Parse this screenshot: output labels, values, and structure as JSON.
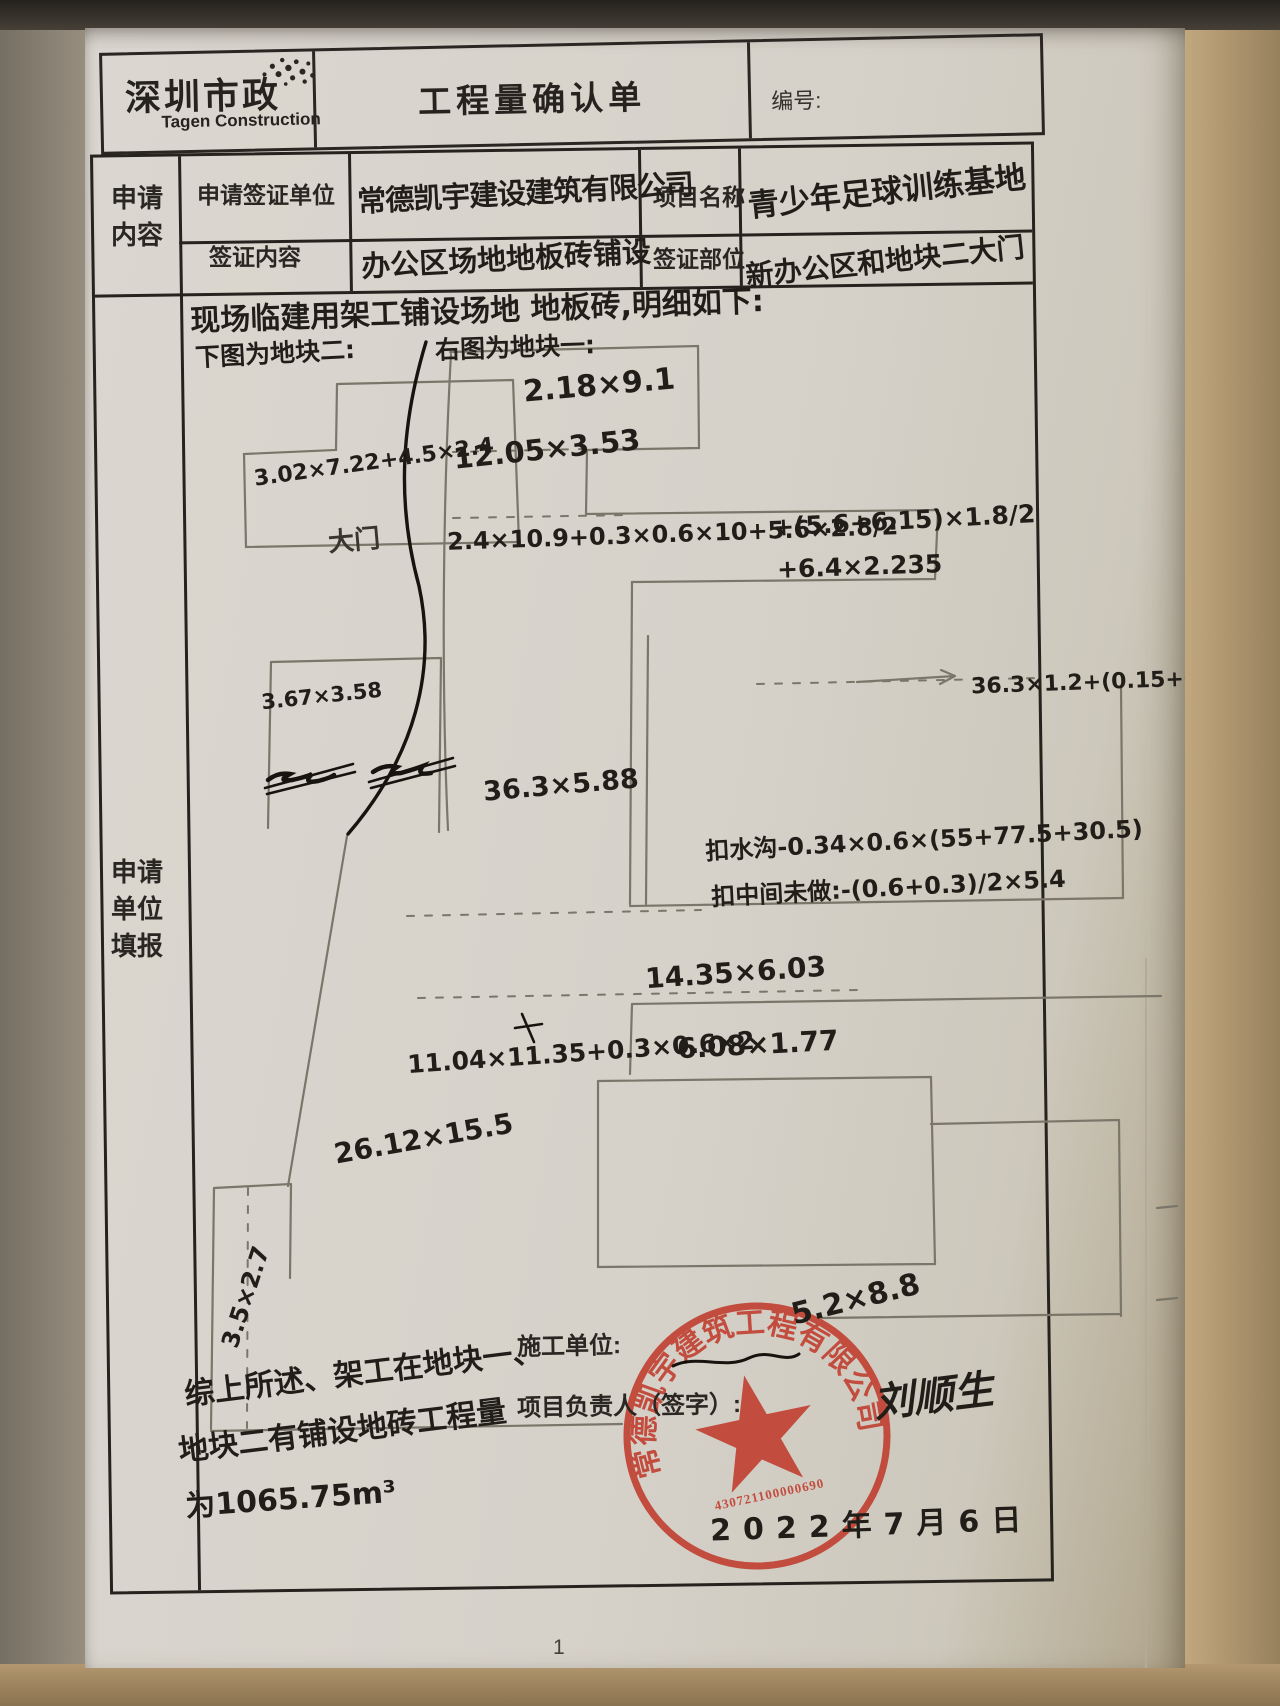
{
  "header": {
    "logo_title": "深圳市政",
    "logo_subtitle": "Tagen Construction",
    "title": "工程量确认单",
    "number_label": "编号:"
  },
  "form": {
    "section_label_top": "申请内容",
    "section_label_main": "申请单位填报",
    "applicant_label": "申请签证单位",
    "applicant_value": "常德凯宇建设建筑有限公司",
    "project_label": "项目名称",
    "project_value": "青少年足球训练基地",
    "content_label": "签证内容",
    "content_value": "办公区场地地板砖铺设",
    "location_label": "签证部位",
    "location_value": "新办公区和地块二大门"
  },
  "notes": {
    "intro": "现场临建用架工铺设场地 地板砖,明细如下:",
    "left_caption": "下图为地块二:",
    "right_caption": "右图为地块一:"
  },
  "sketch": {
    "labels": [
      "2.18×9.1",
      "12.05×3.53",
      "2.4×10.9+0.3×0.6×10+5.6×2.8/2",
      "+(5.6+6.15)×1.8/2",
      "+6.4×2.235",
      "3.02×7.22+4.5×2.4",
      "大门",
      "3.67×3.58",
      "36.3×5.88",
      "36.3×1.2+(0.15+0.125)×36.3",
      "扣水沟-0.34×0.6×(55+77.5+30.5)",
      "扣中间未做:-(0.6+0.3)/2×5.4",
      "14.35×6.03",
      "11.04×11.35+0.3×0.6×2",
      "6.08×1.77",
      "26.12×15.5",
      "3.5×2.7",
      "5.2×8.8"
    ]
  },
  "footer": {
    "summary_line1": "综上所述、架工在地块一、",
    "summary_line2": "地块二有铺设地砖工程量",
    "summary_line3": "为1065.75m³",
    "constructor_label": "施工单位:",
    "manager_label": "项目负责人（签字）:",
    "signature": "刘顺生",
    "date": "2022年7月6日"
  },
  "stamp": {
    "company": "常德凯宇建筑工程有限公司",
    "number": "430721100000690"
  },
  "page_number": "1",
  "colors": {
    "stamp_red": "#c03a2b",
    "pencil_gray": "#7b766a",
    "ink_black": "#17140f"
  }
}
